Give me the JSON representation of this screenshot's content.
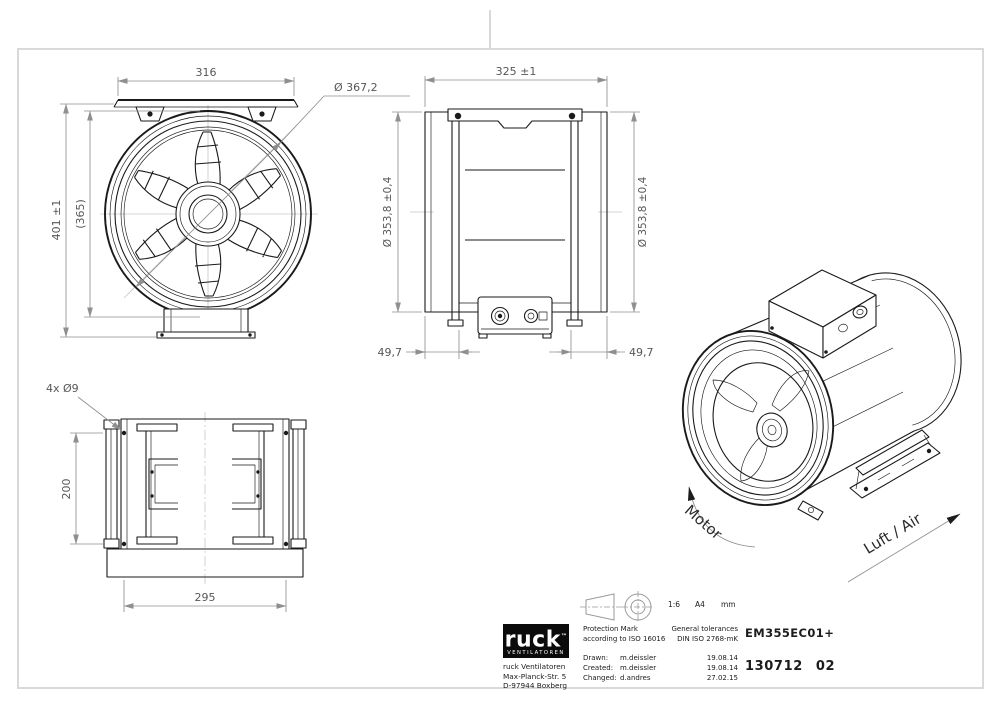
{
  "sheet": {
    "background": "#ffffff",
    "frame_color": "#d9d9d9",
    "object_line_color": "#1a1a1a",
    "dim_line_color": "#8f8f8f",
    "dim_text_color": "#575757",
    "centerline_color": "#c6c6c6"
  },
  "views": {
    "front": {
      "dim_width": "316",
      "dim_outer_diameter": "Ø 367,2",
      "dim_overall_height": "401 ±1",
      "dim_ref_height": "(365)"
    },
    "side": {
      "dim_length": "325 ±1",
      "dim_diameter_left": "Ø 353,8 ±0,4",
      "dim_diameter_right": "Ø 353,8 ±0,4",
      "dim_end_offset_left": "49,7",
      "dim_end_offset_right": "49,7"
    },
    "bottom": {
      "dim_holes": "4x Ø9",
      "dim_hole_pitch_vertical": "200",
      "dim_hole_pitch_horizontal": "295"
    },
    "iso": {
      "label_motor": "Motor",
      "label_airflow": "Luft / Air"
    }
  },
  "titleblock": {
    "logo": {
      "text": "ruck",
      "tm": "™",
      "subtext": "VENTILATOREN"
    },
    "company_lines": [
      "ruck Ventilatoren",
      "Max-Planck-Str. 5",
      "D-97944 Boxberg"
    ],
    "scale": "1:6",
    "format": "A4",
    "units": "mm",
    "protection_line1": "Protection Mark",
    "protection_line2": "according to ISO 16016",
    "tolerance_line1": "General tolerances",
    "tolerance_line2": "DIN ISO 2768-mK",
    "rows": [
      {
        "label": "Drawn:",
        "name": "m.deissler",
        "date": "19.08.14"
      },
      {
        "label": "Created:",
        "name": "m.deissler",
        "date": "19.08.14"
      },
      {
        "label": "Changed:",
        "name": "d.andres",
        "date": "27.02.15"
      }
    ],
    "part_number": "EM355EC01+",
    "drawing_number": "130712",
    "revision": "02"
  }
}
